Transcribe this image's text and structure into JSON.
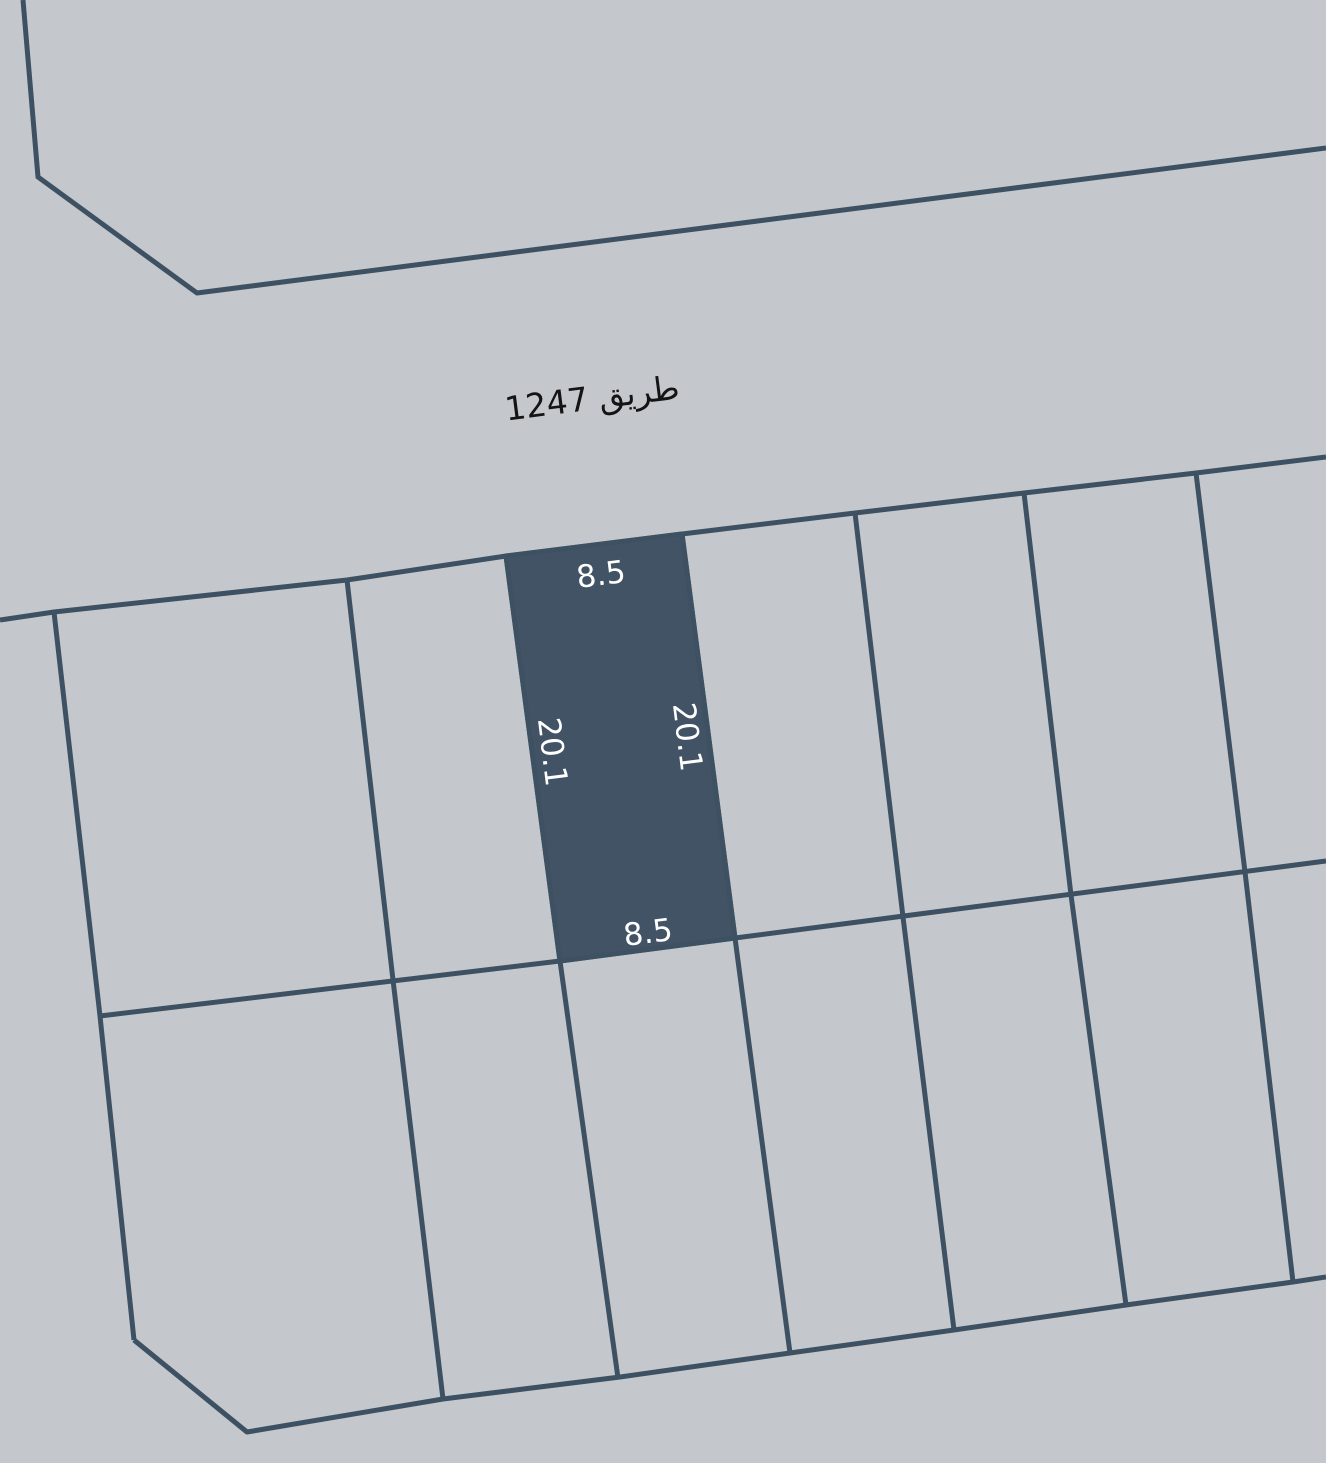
{
  "map": {
    "road_label": "طريق 1247",
    "plot": {
      "top_width": "8.5",
      "bottom_width": "8.5",
      "left_length": "20.1",
      "right_length": "20.1"
    },
    "colors": {
      "background": "#c4c8cd",
      "line": "#3e5163",
      "highlight": "#415365",
      "dimension_text": "#ffffff",
      "road_text": "#141414"
    }
  }
}
